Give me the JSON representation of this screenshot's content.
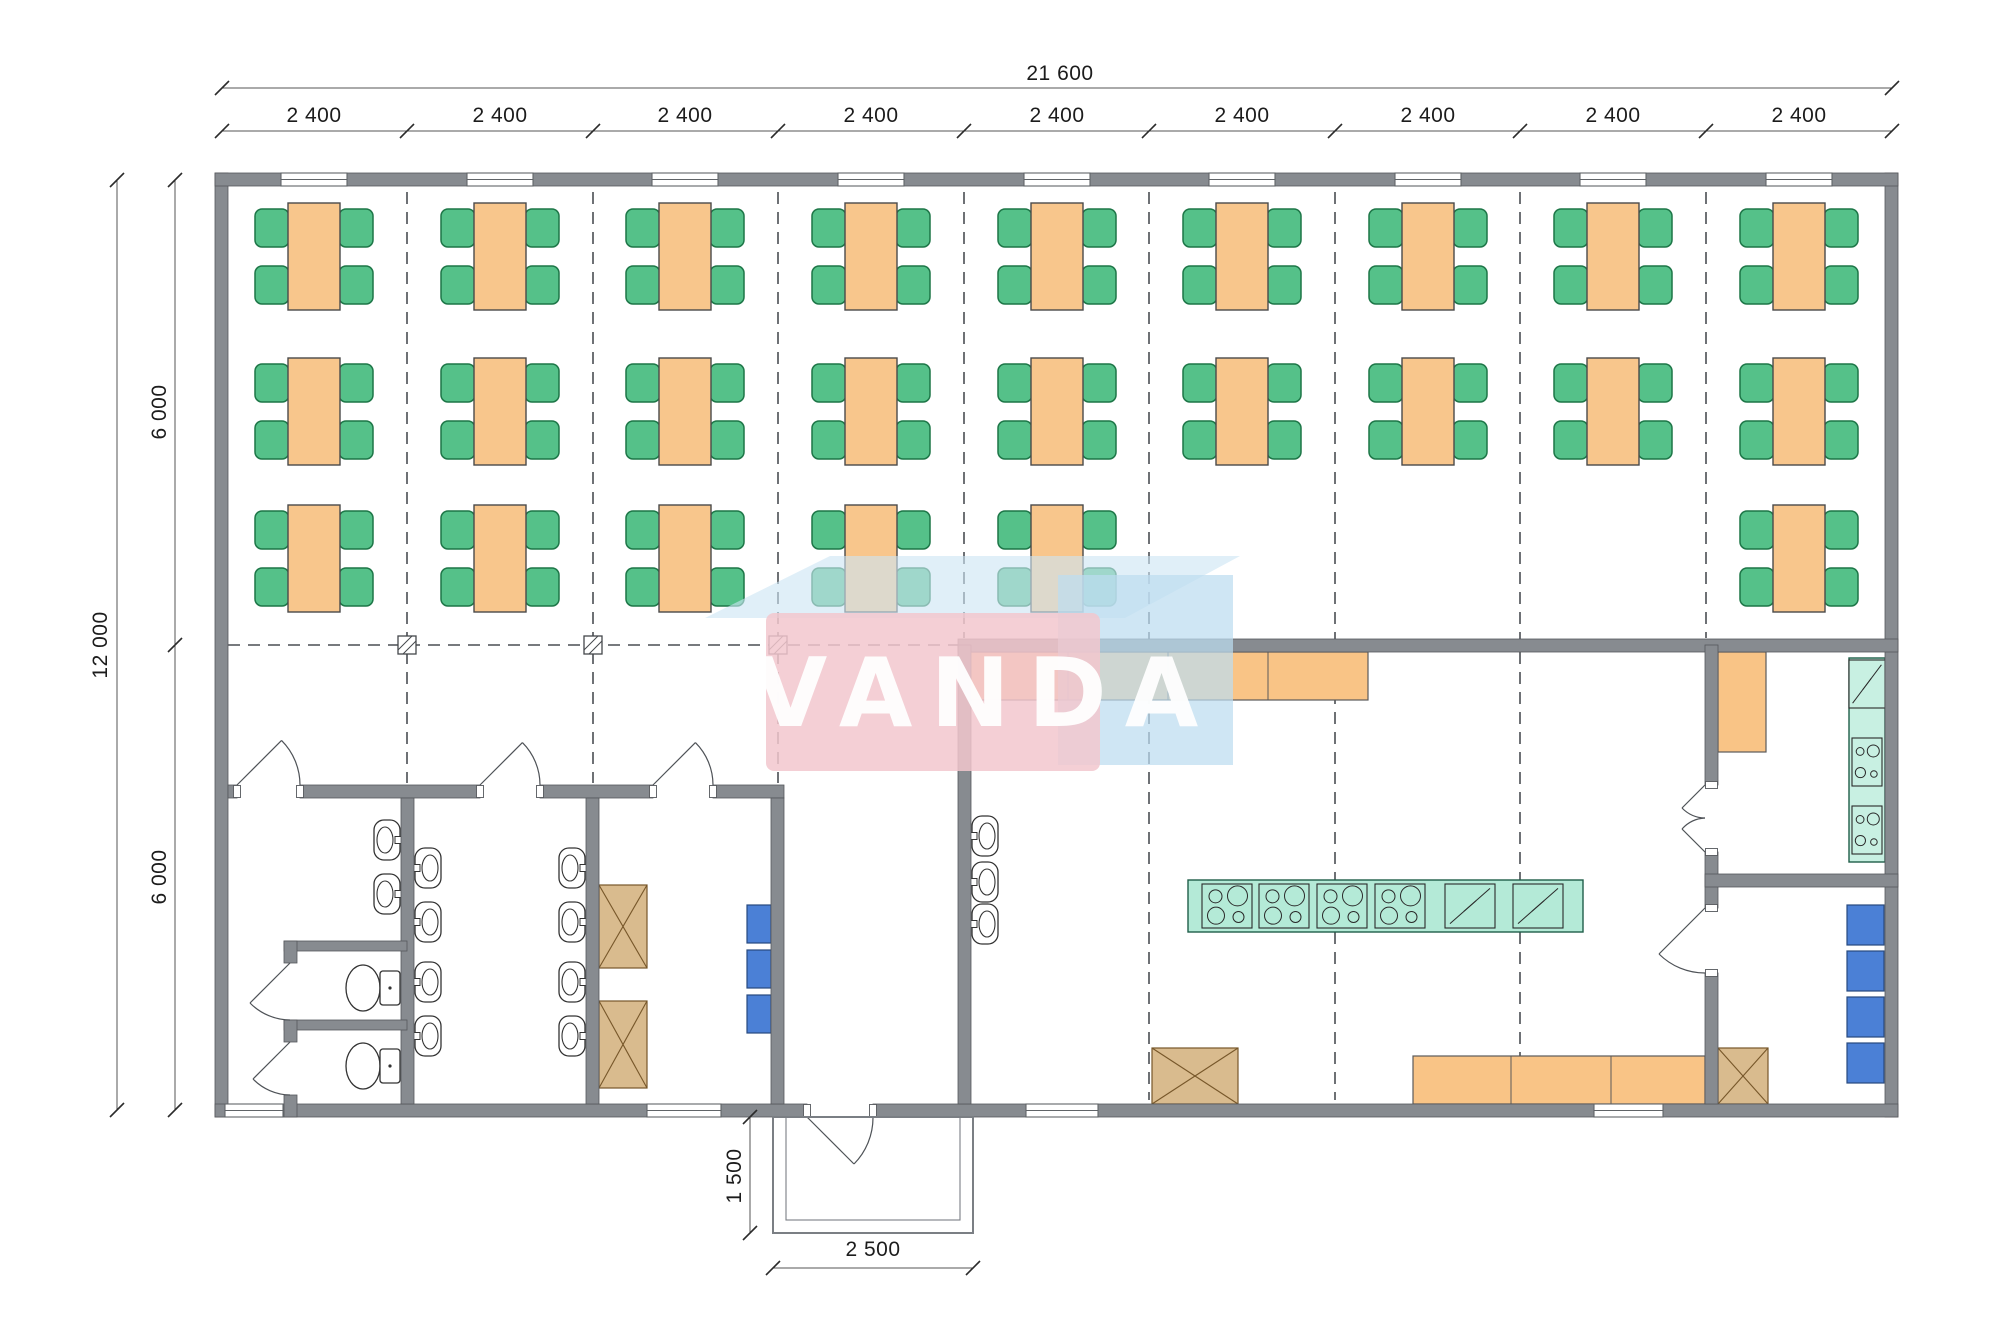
{
  "title": "Canteen building floor plan",
  "dimensions": {
    "total_width": "21 600",
    "bays": [
      "2 400",
      "2 400",
      "2 400",
      "2 400",
      "2 400",
      "2 400",
      "2 400",
      "2 400",
      "2 400"
    ],
    "total_depth": "12 000",
    "depth_back": "6 000",
    "depth_front": "6 000",
    "porch_depth": "1 500",
    "porch_width": "2 500"
  },
  "watermark": {
    "text": "VANDA",
    "pink": "#f2c7ce",
    "blue": "#bcdcf0"
  },
  "colors": {
    "wall": "#878b90",
    "table": "#f8c68c",
    "chair": "#55c189",
    "equipment_teal": "#b4ead7",
    "equipment_teal_light": "#c8f0e2",
    "cabinet_blue": "#4b80d6",
    "storage_tan": "#d9bb8e",
    "counter_orange": "#f9c486",
    "grid": "#4a4e53",
    "dimension": "#2b2b2b"
  },
  "inventory": {
    "dining_tables": 24,
    "chairs": 96,
    "toilets": 2,
    "wash_basins": 13,
    "cooker_units": 6,
    "crossed_storage_boxes": 4,
    "blue_cabinets": 7
  }
}
